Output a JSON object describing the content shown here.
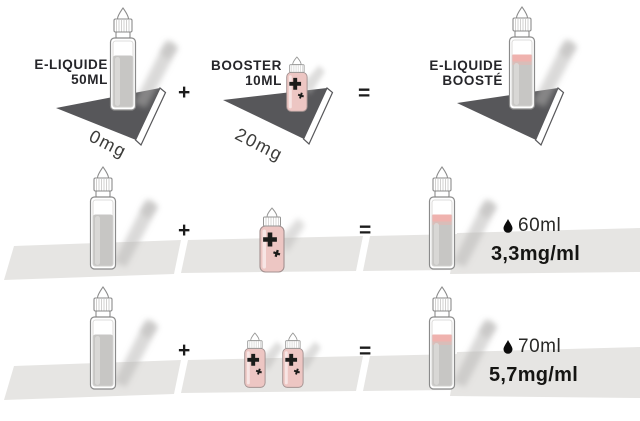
{
  "colors": {
    "triangle": "#57575a",
    "strip": "#e6e5e3",
    "booster_pink": "#edc6c3",
    "liquid_gray": "#c7c6c4",
    "pink_band": "#efb2ae",
    "ink": "#1b1b1b"
  },
  "formula": {
    "eliquid": {
      "line1": "E-LIQUIDE",
      "line2": "50ML",
      "strength": "0mg"
    },
    "booster": {
      "line1": "BOOSTER",
      "line2": "10ML",
      "strength": "20mg"
    },
    "result": {
      "line1": "E-LIQUIDE",
      "line2": "BOOSTÉ"
    }
  },
  "operators": {
    "plus": "+",
    "equals": "="
  },
  "mixes": [
    {
      "boosters": 1,
      "volume": "60ml",
      "concentration": "3,3mg/ml"
    },
    {
      "boosters": 2,
      "volume": "70ml",
      "concentration": "5,7mg/ml"
    }
  ]
}
